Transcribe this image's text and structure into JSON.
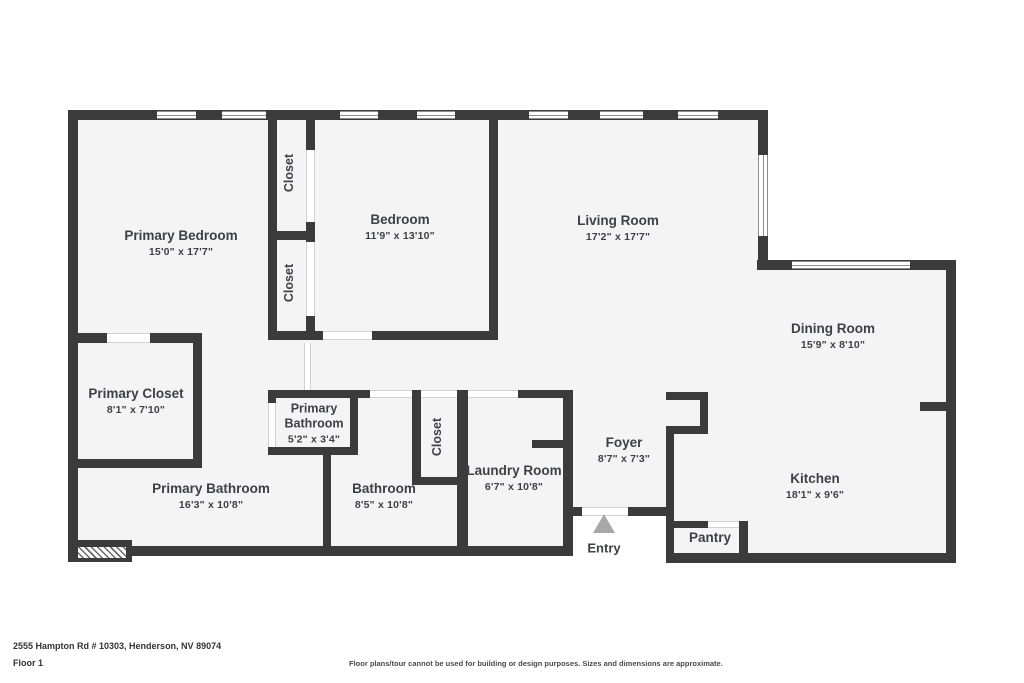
{
  "meta": {
    "address": "2555 Hampton Rd # 10303, Henderson, NV 89074",
    "floor_label": "Floor 1",
    "disclaimer": "Floor plans/tour cannot be used for building or design purposes. Sizes and dimensions are approximate."
  },
  "colors": {
    "wall": "#3b3b3b",
    "floor_fill": "#f4f4f4",
    "label_text": "#3e4046",
    "entry_arrow": "#a8a8a8",
    "background": "#ffffff"
  },
  "labels": {
    "closet": "Closet",
    "entry": "Entry"
  },
  "rooms": [
    {
      "name": "Primary Bedroom",
      "dims": "15'0\" x 17'7\""
    },
    {
      "name": "Bedroom",
      "dims": "11'9\" x 13'10\""
    },
    {
      "name": "Living Room",
      "dims": "17'2\" x 17'7\""
    },
    {
      "name": "Dining Room",
      "dims": "15'9\" x 8'10\""
    },
    {
      "name": "Primary Closet",
      "dims": "8'1\" x 7'10\""
    },
    {
      "name": "Primary Bathroom",
      "dims": "5'2\" x 3'4\""
    },
    {
      "name": "Primary Bathroom",
      "dims": "16'3\" x 10'8\""
    },
    {
      "name": "Bathroom",
      "dims": "8'5\" x 10'8\""
    },
    {
      "name": "Laundry Room",
      "dims": "6'7\" x 10'8\""
    },
    {
      "name": "Foyer",
      "dims": "8'7\" x 7'3\""
    },
    {
      "name": "Kitchen",
      "dims": "18'1\" x 9'6\""
    },
    {
      "name": "Pantry",
      "dims": ""
    }
  ]
}
